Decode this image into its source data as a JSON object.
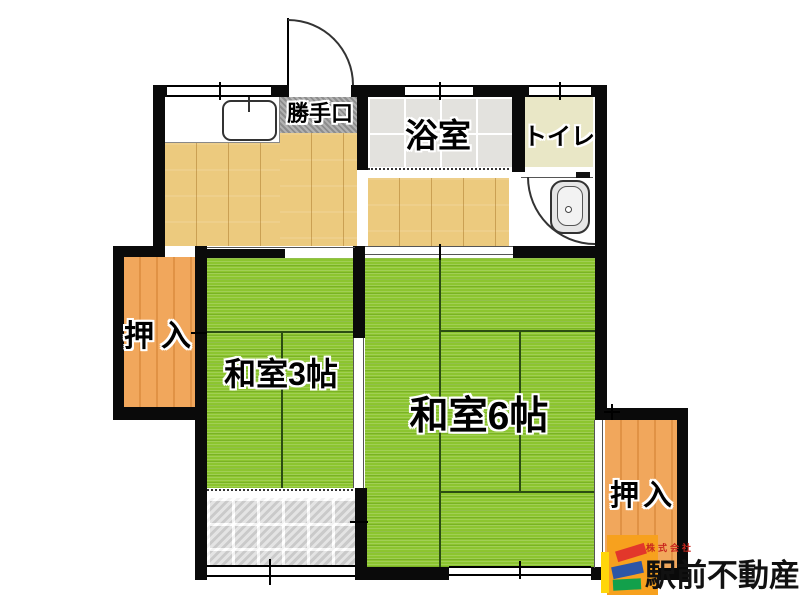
{
  "floorplan": {
    "labels": {
      "back_door": "勝手口",
      "bathroom": "浴室",
      "toilet": "トイレ",
      "closet_left": "押入",
      "closet_right": "押入",
      "japanese_room_3": "和室3帖",
      "japanese_room_6": "和室6帖"
    },
    "rooms": [
      {
        "name": "kitchen-hall",
        "floor": "wood"
      },
      {
        "name": "bathroom",
        "label": "浴室",
        "floor": "tile"
      },
      {
        "name": "toilet",
        "label": "トイレ",
        "floor": "cream"
      },
      {
        "name": "japanese-room-3mat",
        "label": "和室3帖",
        "floor": "tatami"
      },
      {
        "name": "japanese-room-6mat",
        "label": "和室6帖",
        "floor": "tatami"
      },
      {
        "name": "closet-left",
        "label": "押入",
        "floor": "wood-closet"
      },
      {
        "name": "closet-right",
        "label": "押入",
        "floor": "wood-closet"
      },
      {
        "name": "entrance-tiles",
        "floor": "stone-tile"
      }
    ],
    "colors": {
      "tatami": "#8CC52F",
      "wood_floor": "#ECCA7E",
      "closet": "#F1A75C",
      "bath_tile": "#E3E2DE",
      "toilet_floor": "#E9E7C6",
      "entrance_tile": "#D5D5D5",
      "step_stone": "#9D9D9D",
      "wall": "#0A0A0A"
    }
  },
  "logo": {
    "company_prefix": "株式会社",
    "company_name": "駅前不動産",
    "colors": {
      "square": "#F7A11E",
      "bar_yellow": "#FFD60A",
      "bar_red": "#E2372B",
      "bar_blue": "#2D56A7",
      "bar_green": "#12A04B",
      "prefix_text": "#C9271E",
      "name_text": "#111111"
    }
  }
}
